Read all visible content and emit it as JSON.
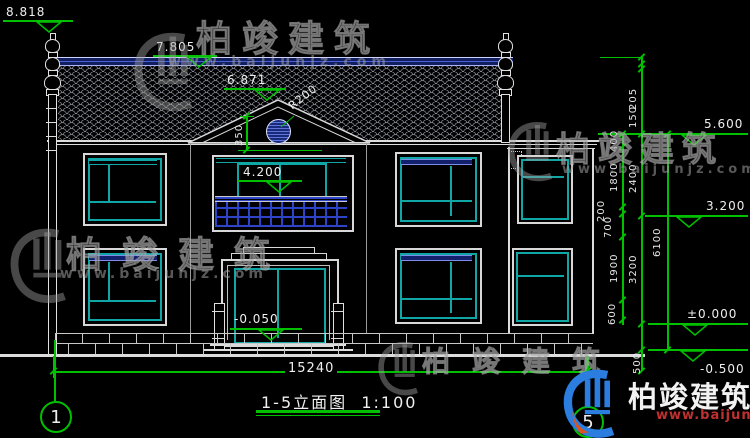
{
  "title": {
    "main": "1-5立面图",
    "scale": "1:100"
  },
  "markers": {
    "finial_top": "8.818",
    "ridge_top": "7.805",
    "gable_apex": "6.871",
    "balcony_level": "4.200",
    "entry_level": "-0.050",
    "parapet_level": "5.600",
    "second_floor": "3.200",
    "ground_floor": "±0.000",
    "site_ground": "-0.500"
  },
  "dims": {
    "overall": "15240",
    "r200": "R200",
    "d350": "350",
    "chainA": [
      "400",
      "1800",
      "200",
      "700",
      "1900",
      "600"
    ],
    "chainB": [
      "205",
      "150",
      "2400",
      "3200",
      "500"
    ],
    "chainC": [
      "6100"
    ]
  },
  "bubbles": {
    "left": "1",
    "right": "5"
  },
  "watermark": {
    "brand": "柏竣建筑",
    "url": "www.baijunjz.com"
  },
  "colors": {
    "background": "#000000",
    "line_white": "#dcdcdc",
    "window_cyan": "#10a6a6",
    "detail_blue": "#2e44c8",
    "band_navy": "#13206b",
    "dimension_green": "#00c000",
    "watermark_gray": "#9a9a9a",
    "logo_blue": "#2b7de0",
    "url_red": "#c03030"
  }
}
